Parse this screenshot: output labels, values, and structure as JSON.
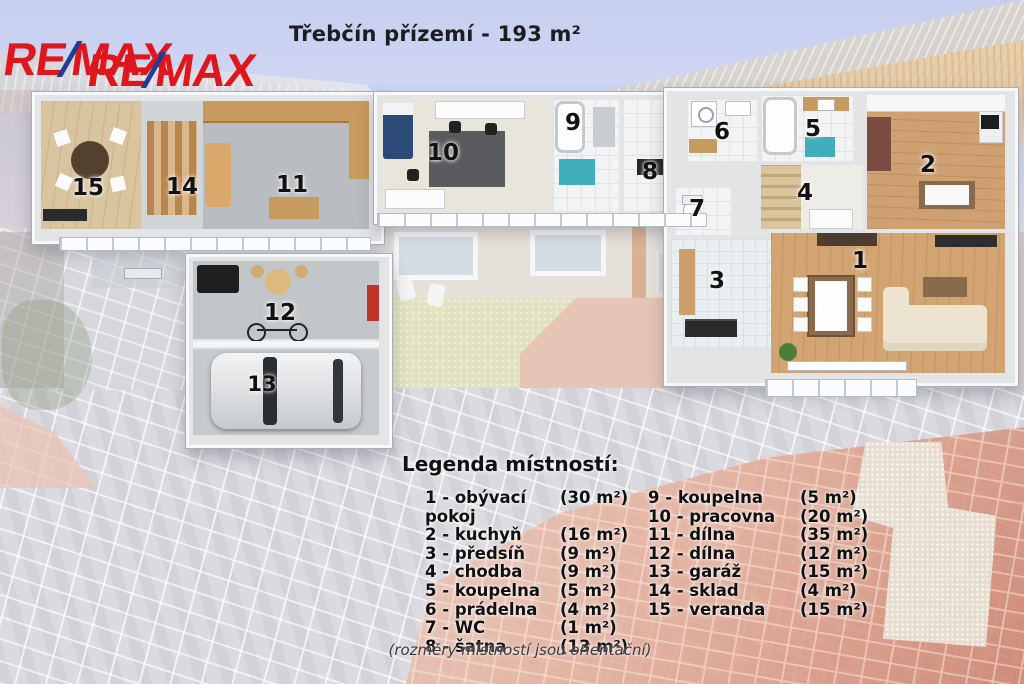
{
  "header": {
    "title": "Třebčín přízemí - 193 m²"
  },
  "brand": {
    "re": "RE",
    "slash": "/",
    "max": "MAX",
    "color_red": "#e0161d",
    "color_blue": "#1c3f94"
  },
  "floorplan": {
    "rooms": [
      {
        "number": "1",
        "name": "obývací pokoj"
      },
      {
        "number": "2",
        "name": "kuchyň"
      },
      {
        "number": "3",
        "name": "předsíň"
      },
      {
        "number": "4",
        "name": "chodba"
      },
      {
        "number": "5",
        "name": "koupelna"
      },
      {
        "number": "6",
        "name": "prádelna"
      },
      {
        "number": "7",
        "name": "WC"
      },
      {
        "number": "8",
        "name": "šatna"
      },
      {
        "number": "9",
        "name": "koupelna"
      },
      {
        "number": "10",
        "name": "pracovna"
      },
      {
        "number": "11",
        "name": "dílna"
      },
      {
        "number": "12",
        "name": "dílna"
      },
      {
        "number": "13",
        "name": "garáž"
      },
      {
        "number": "14",
        "name": "sklad"
      },
      {
        "number": "15",
        "name": "veranda"
      }
    ]
  },
  "legend": {
    "heading": "Legenda místností:",
    "items": [
      {
        "label": "1 - obývací pokoj",
        "area": "(30 m²)"
      },
      {
        "label": "2 - kuchyň",
        "area": "(16 m²)"
      },
      {
        "label": "3 - předsíň",
        "area": "(9 m²)"
      },
      {
        "label": "4 - chodba",
        "area": "(9 m²)"
      },
      {
        "label": "5 - koupelna",
        "area": "(5 m²)"
      },
      {
        "label": "6 - prádelna",
        "area": "(4 m²)"
      },
      {
        "label": "7 - WC",
        "area": "(1 m²)"
      },
      {
        "label": "8 - šatna",
        "area": "(13 m²)"
      },
      {
        "label": "9 - koupelna",
        "area": "(5 m²)"
      },
      {
        "label": "10 - pracovna",
        "area": "(20 m²)"
      },
      {
        "label": "11 - dílna",
        "area": "(35 m²)"
      },
      {
        "label": "12 - dílna",
        "area": "(12 m²)"
      },
      {
        "label": "13 - garáž",
        "area": "(15 m²)"
      },
      {
        "label": "14 - sklad",
        "area": "(4 m²)"
      },
      {
        "label": "15 - veranda",
        "area": "(15 m²)"
      }
    ],
    "note": "(rozměry místností jsou orientační)"
  }
}
